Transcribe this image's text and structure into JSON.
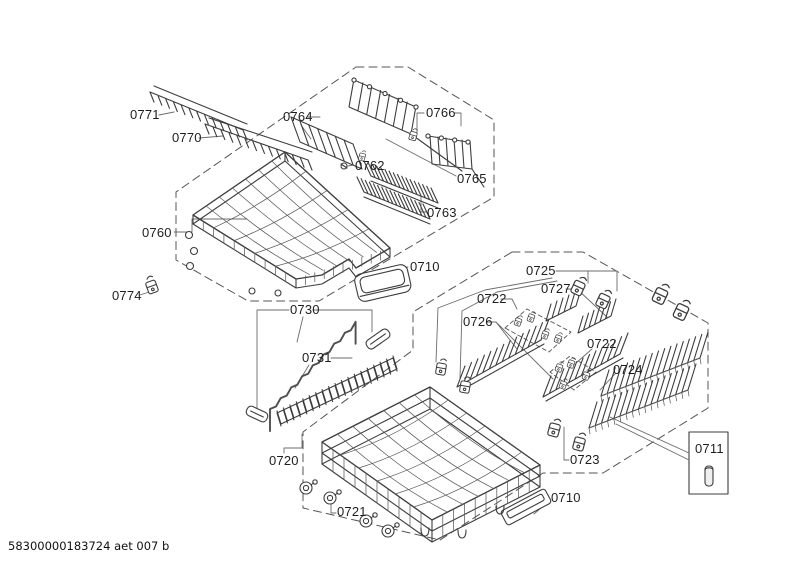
{
  "diagram": {
    "footer_code": "58300000183724 aet 007 b",
    "labels": {
      "l0771": "0771",
      "l0770": "0770",
      "l0764": "0764",
      "l0766": "0766",
      "l0762": "0762",
      "l0765": "0765",
      "l0763": "0763",
      "l0760": "0760",
      "l0774": "0774",
      "l0710_top": "0710",
      "l0730": "0730",
      "l0731": "0731",
      "l0725": "0725",
      "l0727": "0727",
      "l0722_upper": "0722",
      "l0726": "0726",
      "l0722_lower": "0722",
      "l0724": "0724",
      "l0720": "0720",
      "l0721": "0721",
      "l0723": "0723",
      "l0711": "0711",
      "l0710_bottom": "0710"
    }
  }
}
